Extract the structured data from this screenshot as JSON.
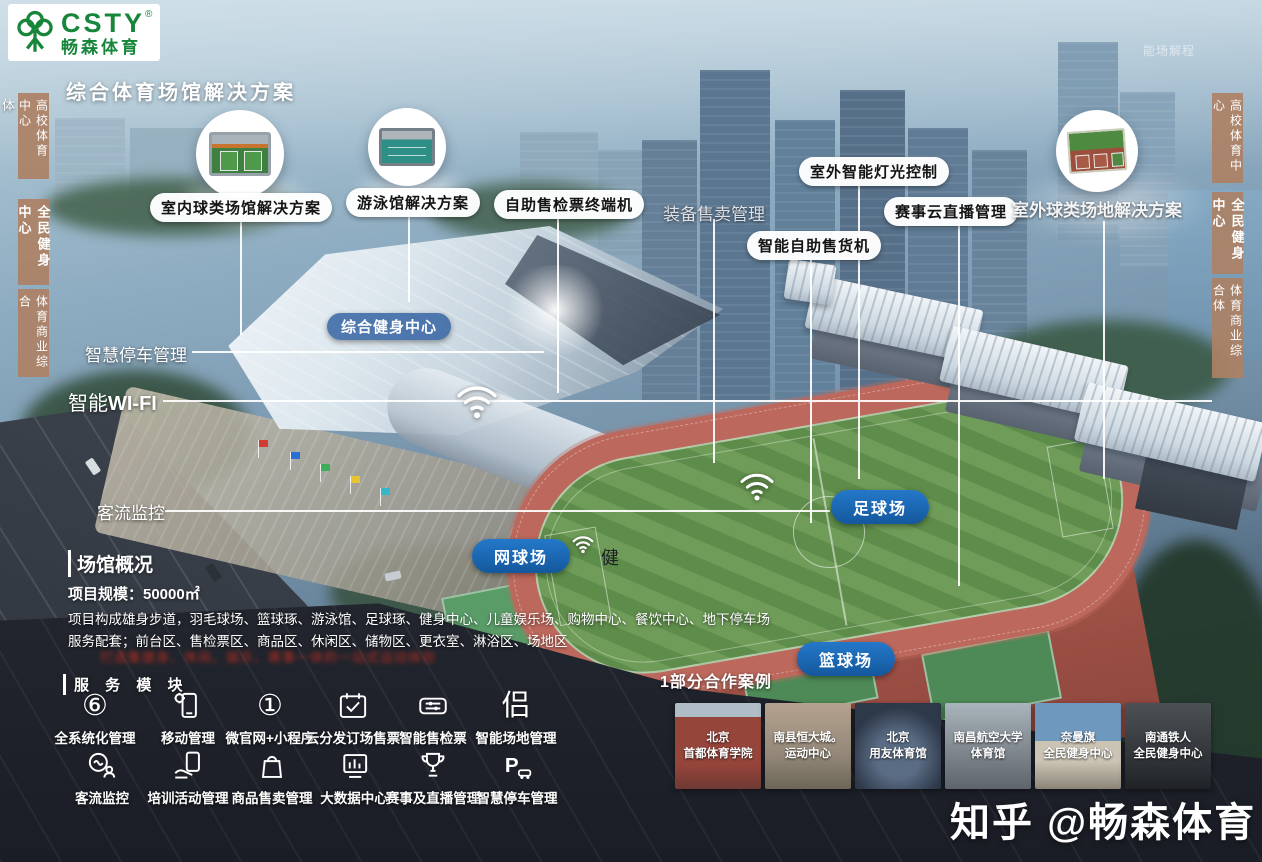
{
  "accents": {
    "brand_green": "#17863b",
    "pill_blue": "#14589d",
    "tab_tan": "#ac8165",
    "note_red": "#d22f1e"
  },
  "header": {
    "logo_text": "CSTY",
    "logo_reg": "®",
    "logo_sub": "畅森体育",
    "title": "综合体育场馆解决方案",
    "faint_note": "能场解程"
  },
  "edge_tabs": {
    "left_partial": "体",
    "left": [
      "高校体育中心",
      "全民健身中心",
      "体育商业综合"
    ],
    "right": [
      "高校体育中心",
      "全民健身中心",
      "体育商业综合体"
    ]
  },
  "callouts": {
    "indoor_ball": "室内球类场馆解决方案",
    "swimming": "游泳馆解决方案",
    "ticket_terminal": "自助售检票终端机",
    "equipment_sale": "装备售卖管理",
    "vending": "智能自助售货机",
    "outdoor_light": "室外智能灯光控制",
    "cloud_broadcast": "赛事云直播管理",
    "outdoor_ball": "室外球类场地解决方案",
    "fitness_center": "综合健身中心",
    "smart_parking": "智慧停车管理",
    "smart_wifi_prefix": "智能",
    "smart_wifi_en": "WI-FI",
    "visitor_monitor": "客流监控",
    "football": "足球场",
    "tennis": "网球场",
    "basketball": "篮球场",
    "jian_char": "健"
  },
  "overview": {
    "heading": "场馆概况",
    "scale": "项目规模：50000㎡",
    "composition": "项目构成雄身步道，羽毛球场、篮球琢、游泳馆、足球琢、健身中心、儿童娱乐场、购物中心、餐饮中心、地下停车场",
    "services": "服务配套；前台区、售检票区、商品区、休闲区、储物区、更衣室、淋浴区、场地区",
    "red_note": "打造集健身、休闲、娱乐、赛事一体的一站式运动体验"
  },
  "modules": {
    "heading": "服 务 模 块",
    "row1": [
      {
        "glyph": "⑥",
        "label": "全系统化管理"
      },
      {
        "label": "移动管理"
      },
      {
        "glyph": "①",
        "label": "微官网+小程序"
      },
      {
        "label": "云分发订场售票"
      },
      {
        "label": "智能售检票"
      },
      {
        "glyph": "侣",
        "label": "智能场地管理"
      }
    ],
    "row2": [
      {
        "label": "客流监控"
      },
      {
        "label": "培训活动管理"
      },
      {
        "label": "商品售卖管理"
      },
      {
        "label": "大数据中心"
      },
      {
        "label": "赛事及直播管理"
      },
      {
        "label": "智慧停车管理"
      }
    ]
  },
  "cases": {
    "heading": "1部分合作案例",
    "items": [
      {
        "line1": "北京",
        "line2": "首都体育学院"
      },
      {
        "line1": "南县恒大城。",
        "line2": "运动中心"
      },
      {
        "line1": "北京",
        "line2": "用友体育馆"
      },
      {
        "line1": "南昌航空大学",
        "line2": "体育馆"
      },
      {
        "line1": "奈曼旗",
        "line2": "全民健身中心"
      },
      {
        "line1": "南通铁人",
        "line2": "全民健身中心"
      }
    ]
  },
  "watermark": "知乎 @畅森体育"
}
